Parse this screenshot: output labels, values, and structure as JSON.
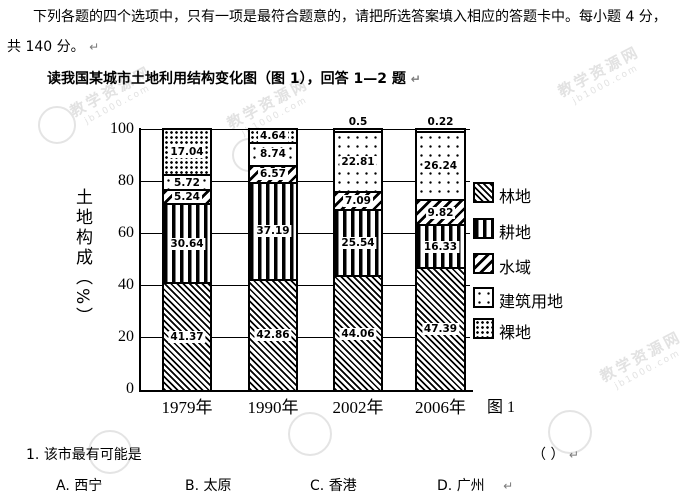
{
  "page": {
    "intro_line1": "下列各题的四个选项中，只有一项是最符合题意的，请把所选答案填入相应的答题卡中。每小题 4 分，",
    "intro_line2": "共 140 分。",
    "reading_instruction": "读我国某城市土地利用结构变化图（图 1），回答 1—2 题",
    "pilcrow": "↵"
  },
  "chart_data": {
    "type": "bar",
    "stacked": true,
    "title": "",
    "ylabel": "土地构成（%）",
    "xlabel": "",
    "ylim": [
      0,
      100
    ],
    "yticks": [
      0,
      20,
      40,
      60,
      80,
      100
    ],
    "grid": true,
    "legend_position": "right",
    "categories": [
      "1979年",
      "1990年",
      "2002年",
      "2006年"
    ],
    "series": [
      {
        "name": "林地",
        "key": "forest",
        "pattern": "diagonal-backslash-hatch",
        "values": [
          41.37,
          42.86,
          44.06,
          47.39
        ]
      },
      {
        "name": "耕地",
        "key": "cultivated",
        "pattern": "vertical-bars",
        "values": [
          30.64,
          37.19,
          25.54,
          16.33
        ]
      },
      {
        "name": "水域",
        "key": "water",
        "pattern": "diagonal-slash-hatch",
        "values": [
          5.24,
          6.57,
          7.09,
          9.82
        ]
      },
      {
        "name": "建筑用地",
        "key": "construction",
        "pattern": "sparse-dots",
        "values": [
          5.72,
          8.74,
          22.81,
          26.24
        ]
      },
      {
        "name": "裸地",
        "key": "bare",
        "pattern": "dense-dots",
        "values": [
          17.04,
          4.64,
          0.5,
          0.22
        ]
      }
    ],
    "caption": "图 1"
  },
  "question": {
    "number": "1.",
    "text": "该市最有可能是",
    "answer_blank": "（      ）",
    "options": [
      {
        "label": "A.",
        "city": "西宁"
      },
      {
        "label": "B.",
        "city": "太原"
      },
      {
        "label": "C.",
        "city": "香港"
      },
      {
        "label": "D.",
        "city": "广州"
      }
    ]
  },
  "watermark": {
    "text": "教学资源网",
    "site": "jb1000.com",
    "color": "#e2e2e2"
  }
}
